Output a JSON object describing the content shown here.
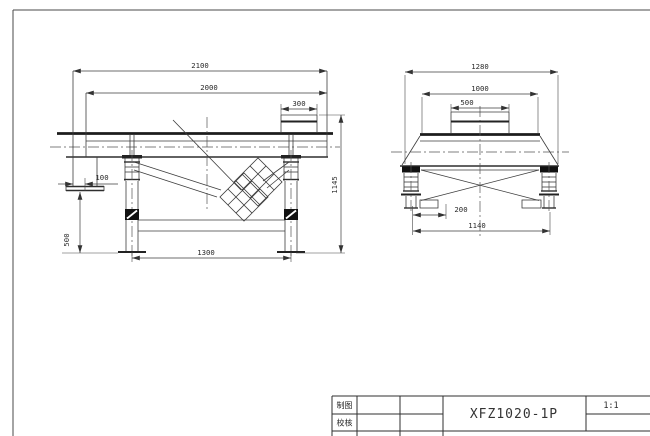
{
  "drawing": {
    "model": "XFZ1020-1P",
    "scale": "1:1",
    "title_block": {
      "drawn_by_label": "制图",
      "checked_by_label": "校核"
    },
    "front_view": {
      "dims": {
        "overall_length": "2100",
        "trough_length": "2000",
        "inlet_length": "300",
        "outlet_offset": "100",
        "outlet_height": "500",
        "support_span": "1300",
        "overall_height": "1145"
      }
    },
    "end_view": {
      "dims": {
        "overall_width": "1280",
        "trough_width": "1000",
        "inlet_width": "500",
        "outlet_offset": "200",
        "base_width": "1140"
      }
    }
  }
}
